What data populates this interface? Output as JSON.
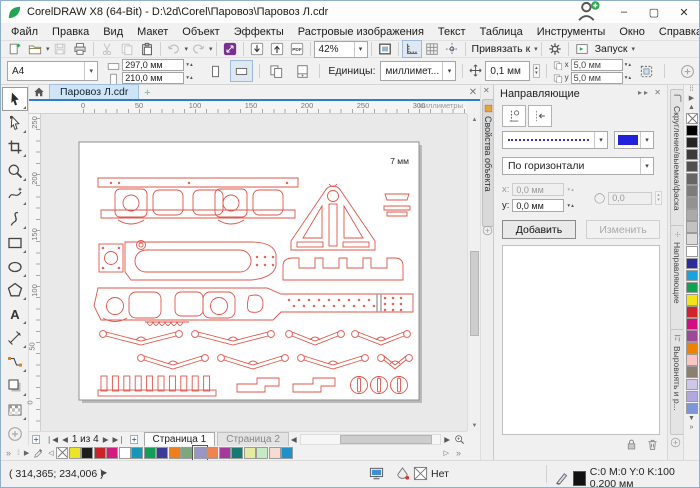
{
  "window": {
    "title": "CorelDRAW X8 (64-Bit) - D:\\2d\\Corel\\Паровоз\\Паровоз Л.cdr",
    "minimize": "–",
    "maximize": "▢",
    "close": "✕"
  },
  "menu": {
    "items": [
      "Файл",
      "Правка",
      "Вид",
      "Макет",
      "Объект",
      "Эффекты",
      "Растровые изображения",
      "Текст",
      "Таблица",
      "Инструменты",
      "Окно",
      "Справка"
    ]
  },
  "toolbar": {
    "zoom_value": "42%",
    "snap_label": "Привязать к",
    "launch_label": "Запуск",
    "buttons": [
      {
        "icon": "new-document"
      },
      {
        "icon": "open-folder",
        "dropdown": true
      },
      {
        "icon": "save",
        "disabled": true
      },
      {
        "icon": "print"
      },
      {
        "sep": true
      },
      {
        "icon": "cut",
        "disabled": true
      },
      {
        "icon": "copy",
        "disabled": true
      },
      {
        "icon": "paste"
      },
      {
        "sep": true
      },
      {
        "icon": "undo",
        "disabled": true,
        "dropdown": true
      },
      {
        "icon": "redo",
        "disabled": true,
        "dropdown": true
      },
      {
        "sep": true
      },
      {
        "icon": "search-content"
      },
      {
        "sep": true
      },
      {
        "icon": "import"
      },
      {
        "icon": "export"
      },
      {
        "icon": "pdf"
      },
      {
        "sep": true
      },
      {
        "zoom": true
      },
      {
        "sep": true
      },
      {
        "icon": "fullscreen-preview"
      },
      {
        "sep": true
      },
      {
        "icon": "show-rulers",
        "pressed": true
      },
      {
        "icon": "show-grid"
      },
      {
        "icon": "show-guidelines"
      },
      {
        "sep": true
      },
      {
        "snap": true
      },
      {
        "sep": true
      },
      {
        "icon": "options-gear"
      },
      {
        "sep": true
      },
      {
        "launch": true
      }
    ]
  },
  "propbar": {
    "paper_size": "A4",
    "page_width": "297,0 мм",
    "page_height": "210,0 мм",
    "units_label": "Единицы:",
    "units_value": "миллимет...",
    "nudge_value": "0,1 мм",
    "dup_x_label": "x",
    "dup_x": "5,0 мм",
    "dup_y_label": "y",
    "dup_y": "5,0 мм"
  },
  "tabs": {
    "doc_tab": "Паровоз Л.cdr",
    "new_tab": "+",
    "close": "✕"
  },
  "hruler": {
    "ticks": [
      "0",
      "50",
      "100",
      "150",
      "200",
      "250",
      "300"
    ],
    "units": "миллиметры"
  },
  "vruler": {
    "ticks": [
      "250",
      "200",
      "150",
      "100",
      "50",
      "0"
    ]
  },
  "canvas": {
    "note": "7 мм"
  },
  "docker": {
    "title": "Направляющие",
    "orientation": "По горизонтали",
    "x_label": "x:",
    "x_value": "0,0 мм",
    "y_label": "y:",
    "y_value": "0,0 мм",
    "angle_value": "0,0",
    "add_label": "Добавить",
    "edit_label": "Изменить",
    "guide_color": "#2222dd"
  },
  "dock_tabs": {
    "left": "Свойства объекта",
    "right": [
      {
        "label": "Скругление/выемка/фаска",
        "icon": "fillet-tab-icon",
        "height": 132
      },
      {
        "label": "Направляющие",
        "icon": "guidelines-tab-icon",
        "height": 96,
        "top": 140
      },
      {
        "label": "Выровнять и р...",
        "icon": "align-tab-icon",
        "height": 96,
        "top": 244
      }
    ]
  },
  "toolbox": {
    "tools": [
      "pick-tool",
      "shape-tool",
      "crop-tool",
      "zoom-tool",
      "freehand-tool",
      "artistic-media-tool",
      "rectangle-tool",
      "ellipse-tool",
      "polygon-tool",
      "text-tool",
      "dimension-tool",
      "connector-tool",
      "drop-shadow-tool",
      "transparency-tool"
    ],
    "selected": "pick-tool"
  },
  "pagenav": {
    "counter": "1 из 4",
    "page_tabs": [
      "Страница 1",
      "Страница 2"
    ]
  },
  "statusbar": {
    "coords": "( 314,365; 234,006 )",
    "fill_value": "Нет",
    "outline_value": "C:0 M:0 Y:0 K:100  0,200 мм"
  },
  "palettes": {
    "document": [
      "none",
      "#ece32a",
      "#1d1d1b",
      "#cc2229",
      "#d41a7d",
      "#ffffff",
      "#1398b9",
      "#109e58",
      "#3c3c96",
      "#ee7f1b",
      "#7fa77f",
      "#9a95c6",
      "#ef8352",
      "#a43a9d",
      "#17796f",
      "#e3ec9e",
      "#c6ebc4",
      "#f7dcd2",
      "#2090c8"
    ],
    "document_selected_index": 11,
    "main": [
      "none",
      "#000000",
      "#242424",
      "#3a3a3a",
      "#505050",
      "#666666",
      "#7c7c7c",
      "#929292",
      "#aaaaaa",
      "#c2c2c2",
      "#dcdcdc",
      "#ffffff",
      "#2b2b9c",
      "#19a2dc",
      "#10a251",
      "#f3e515",
      "#d3232a",
      "#d60c85",
      "#9c4a98",
      "#ee8200",
      "#f9c6c4",
      "#8b7f72",
      "#cfc7ea",
      "#b2a7df",
      "#7d96d7"
    ]
  },
  "drawing": {
    "stroke": "#e0554a"
  }
}
